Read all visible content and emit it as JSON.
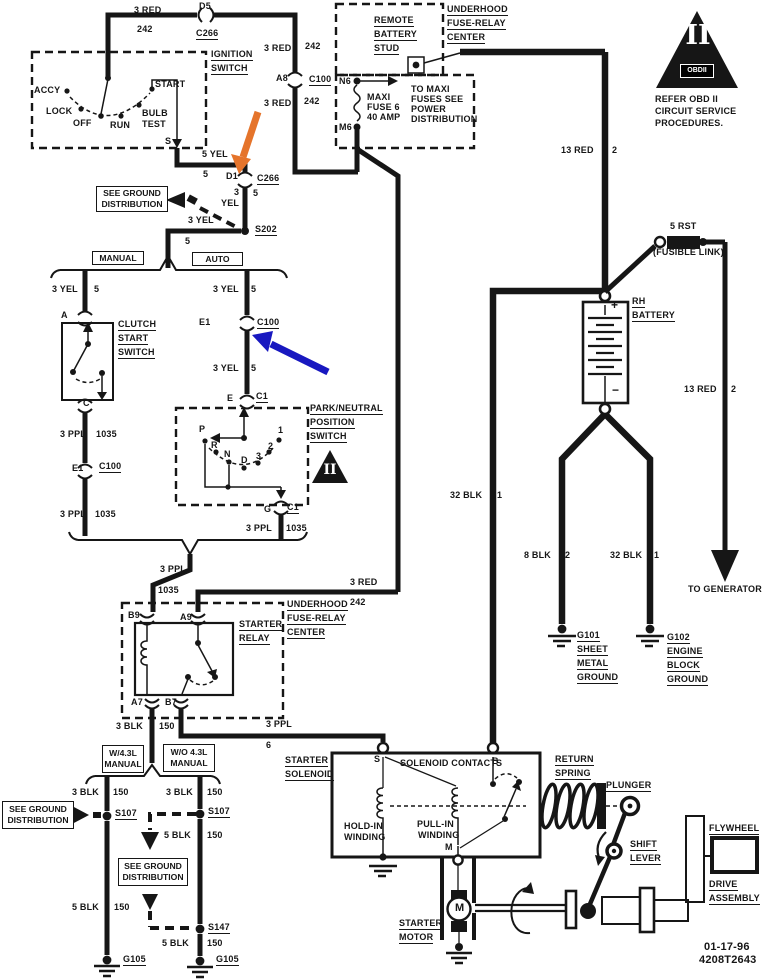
{
  "colors": {
    "paper": "#ffffff",
    "ink": "#161616",
    "arrow_orange": "#e5742b",
    "arrow_blue": "#1818c0"
  },
  "obd_notice": {
    "numeral": "II",
    "badge": "OBDII"
  },
  "pn_triangle": {
    "numeral": "II"
  },
  "footer": {
    "date": "01-17-96",
    "code": "4208T2643"
  },
  "boxed_labels": [
    {
      "n": "see-ground-distribution-top",
      "x": 96,
      "y": 186,
      "w": 70,
      "h": 24,
      "lines": [
        "SEE GROUND",
        "DISTRIBUTION"
      ]
    },
    {
      "n": "manual-tag",
      "x": 92,
      "y": 251,
      "w": 50,
      "h": 12,
      "lines": [
        "MANUAL"
      ]
    },
    {
      "n": "auto-tag",
      "x": 192,
      "y": 252,
      "w": 49,
      "h": 12,
      "lines": [
        "AUTO"
      ]
    },
    {
      "n": "w-43l-manual-tag",
      "x": 102,
      "y": 745,
      "w": 40,
      "h": 26,
      "lines": [
        "W/4.3L",
        "MANUAL"
      ]
    },
    {
      "n": "wo-43l-manual-tag",
      "x": 163,
      "y": 744,
      "w": 50,
      "h": 26,
      "lines": [
        "W/O 4.3L",
        "MANUAL"
      ]
    },
    {
      "n": "see-ground-distribution-left",
      "x": 2,
      "y": 801,
      "w": 70,
      "h": 26,
      "lines": [
        "SEE GROUND",
        "DISTRIBUTION"
      ]
    },
    {
      "n": "see-ground-distribution-bottom",
      "x": 118,
      "y": 858,
      "w": 68,
      "h": 26,
      "lines": [
        "SEE GROUND",
        "DISTRIBUTION"
      ]
    }
  ],
  "labels": [
    {
      "n": "wire-3red-top",
      "t": "3 RED",
      "x": 134,
      "y": 5
    },
    {
      "n": "wire-242-top",
      "t": "242",
      "x": 137,
      "y": 24
    },
    {
      "n": "conn-d5",
      "t": "D5",
      "x": 199,
      "y": 1
    },
    {
      "n": "conn-c266-top",
      "t": "C266",
      "x": 196,
      "y": 28,
      "u": 1
    },
    {
      "n": "wire-3red-2",
      "t": "3 RED",
      "x": 264,
      "y": 43
    },
    {
      "n": "wire-242-2",
      "t": "242",
      "x": 305,
      "y": 41
    },
    {
      "n": "conn-a8",
      "t": "A8",
      "x": 276,
      "y": 73
    },
    {
      "n": "conn-c100-top",
      "t": "C100",
      "x": 309,
      "y": 74,
      "u": 1
    },
    {
      "n": "wire-3red-3",
      "t": "3 RED",
      "x": 264,
      "y": 98
    },
    {
      "n": "wire-242-3",
      "t": "242",
      "x": 304,
      "y": 96
    },
    {
      "n": "ignition-label-1",
      "t": "IGNITION",
      "x": 211,
      "y": 49,
      "u": 1
    },
    {
      "n": "ignition-label-2",
      "t": "SWITCH",
      "x": 211,
      "y": 63,
      "u": 1
    },
    {
      "n": "pos-accy",
      "t": "ACCY",
      "x": 34,
      "y": 85
    },
    {
      "n": "pos-lock",
      "t": "LOCK",
      "x": 46,
      "y": 106
    },
    {
      "n": "pos-off",
      "t": "OFF",
      "x": 73,
      "y": 118
    },
    {
      "n": "pos-run",
      "t": "RUN",
      "x": 110,
      "y": 120
    },
    {
      "n": "pos-bulb",
      "t": "BULB",
      "x": 142,
      "y": 108
    },
    {
      "n": "pos-test",
      "t": "TEST",
      "x": 142,
      "y": 119
    },
    {
      "n": "pos-start",
      "t": "START",
      "x": 155,
      "y": 79
    },
    {
      "n": "term-s-ign",
      "t": "S",
      "x": 165,
      "y": 136
    },
    {
      "n": "wire-5yel",
      "t": "5 YEL",
      "x": 202,
      "y": 149
    },
    {
      "n": "wire-5-a",
      "t": "5",
      "x": 203,
      "y": 169
    },
    {
      "n": "conn-d1",
      "t": "D1",
      "x": 226,
      "y": 171
    },
    {
      "n": "conn-c266-mid",
      "t": "C266",
      "x": 257,
      "y": 173,
      "u": 1
    },
    {
      "n": "wire-3-b",
      "t": "3",
      "x": 234,
      "y": 187
    },
    {
      "n": "wire-5-b",
      "t": "5",
      "x": 253,
      "y": 188
    },
    {
      "n": "wire-yel-b",
      "t": "YEL",
      "x": 221,
      "y": 198
    },
    {
      "n": "splice-s202",
      "t": "S202",
      "x": 255,
      "y": 224,
      "u": 1
    },
    {
      "n": "wire-3yel-s202",
      "t": "3 YEL",
      "x": 188,
      "y": 215
    },
    {
      "n": "wire-5-s202",
      "t": "5",
      "x": 185,
      "y": 236
    },
    {
      "n": "wire-3yel-man",
      "t": "3 YEL",
      "x": 52,
      "y": 284
    },
    {
      "n": "wire-5-man",
      "t": "5",
      "x": 94,
      "y": 284
    },
    {
      "n": "term-a-clutch",
      "t": "A",
      "x": 61,
      "y": 310
    },
    {
      "n": "clutch-label-1",
      "t": "CLUTCH",
      "x": 118,
      "y": 319,
      "u": 1
    },
    {
      "n": "clutch-label-2",
      "t": "START",
      "x": 118,
      "y": 333,
      "u": 1
    },
    {
      "n": "clutch-label-3",
      "t": "SWITCH",
      "x": 118,
      "y": 347,
      "u": 1
    },
    {
      "n": "term-c-clutch",
      "t": "C",
      "x": 83,
      "y": 398
    },
    {
      "n": "wire-3ppl-man1",
      "t": "3 PPL",
      "x": 60,
      "y": 429
    },
    {
      "n": "wire-1035-man1",
      "t": "1035",
      "x": 96,
      "y": 429
    },
    {
      "n": "conn-e1-man",
      "t": "E1",
      "x": 72,
      "y": 463
    },
    {
      "n": "conn-c100-man",
      "t": "C100",
      "x": 99,
      "y": 461,
      "u": 1
    },
    {
      "n": "wire-3ppl-man2",
      "t": "3 PPL",
      "x": 60,
      "y": 509
    },
    {
      "n": "wire-1035-man2",
      "t": "1035",
      "x": 95,
      "y": 509
    },
    {
      "n": "wire-3yel-auto1",
      "t": "3 YEL",
      "x": 213,
      "y": 284
    },
    {
      "n": "wire-5-auto1",
      "t": "5",
      "x": 251,
      "y": 284
    },
    {
      "n": "conn-e1-auto",
      "t": "E1",
      "x": 199,
      "y": 317
    },
    {
      "n": "conn-c100-auto",
      "t": "C100",
      "x": 257,
      "y": 317,
      "u": 1
    },
    {
      "n": "wire-3yel-auto2",
      "t": "3 YEL",
      "x": 213,
      "y": 363
    },
    {
      "n": "wire-5-auto2",
      "t": "5",
      "x": 251,
      "y": 363
    },
    {
      "n": "term-e-pn",
      "t": "E",
      "x": 227,
      "y": 393
    },
    {
      "n": "conn-c1-top",
      "t": "C1",
      "x": 256,
      "y": 391,
      "u": 1
    },
    {
      "n": "pn-label-1",
      "t": "PARK/NEUTRAL",
      "x": 310,
      "y": 403,
      "u": 1
    },
    {
      "n": "pn-label-2",
      "t": "POSITION",
      "x": 310,
      "y": 417,
      "u": 1
    },
    {
      "n": "pn-label-3",
      "t": "SWITCH",
      "x": 310,
      "y": 431,
      "u": 1
    },
    {
      "n": "pn-pos-p",
      "t": "P",
      "x": 199,
      "y": 424
    },
    {
      "n": "pn-pos-r",
      "t": "R",
      "x": 211,
      "y": 440
    },
    {
      "n": "pn-pos-n",
      "t": "N",
      "x": 224,
      "y": 449
    },
    {
      "n": "pn-pos-d",
      "t": "D",
      "x": 241,
      "y": 455
    },
    {
      "n": "pn-pos-3",
      "t": "3",
      "x": 256,
      "y": 451
    },
    {
      "n": "pn-pos-2",
      "t": "2",
      "x": 268,
      "y": 441
    },
    {
      "n": "pn-pos-1",
      "t": "1",
      "x": 278,
      "y": 425
    },
    {
      "n": "term-g-pn",
      "t": "G",
      "x": 264,
      "y": 504
    },
    {
      "n": "conn-c1-bot",
      "t": "C1",
      "x": 287,
      "y": 502,
      "u": 1
    },
    {
      "n": "wire-3ppl-pn",
      "t": "3 PPL",
      "x": 246,
      "y": 523
    },
    {
      "n": "wire-1035-pn",
      "t": "1035",
      "x": 286,
      "y": 523
    },
    {
      "n": "wire-3ppl-merge",
      "t": "3 PPL",
      "x": 160,
      "y": 564
    },
    {
      "n": "wire-1035-merge",
      "t": "1035",
      "x": 158,
      "y": 585
    },
    {
      "n": "wire-3red-mid",
      "t": "3 RED",
      "x": 350,
      "y": 577
    },
    {
      "n": "wire-242-mid",
      "t": "242",
      "x": 350,
      "y": 597
    },
    {
      "n": "term-b9",
      "t": "B9",
      "x": 128,
      "y": 610
    },
    {
      "n": "term-a9",
      "t": "A9",
      "x": 180,
      "y": 612
    },
    {
      "n": "relay-label-1",
      "t": "STARTER",
      "x": 239,
      "y": 619,
      "u": 1
    },
    {
      "n": "relay-label-2",
      "t": "RELAY",
      "x": 239,
      "y": 633,
      "u": 1
    },
    {
      "n": "ufrc-label-1",
      "t": "UNDERHOOD",
      "x": 287,
      "y": 599,
      "u": 1
    },
    {
      "n": "ufrc-label-2",
      "t": "FUSE-RELAY",
      "x": 287,
      "y": 613,
      "u": 1
    },
    {
      "n": "ufrc-label-3",
      "t": "CENTER",
      "x": 287,
      "y": 627,
      "u": 1
    },
    {
      "n": "term-a7",
      "t": "A7",
      "x": 131,
      "y": 697
    },
    {
      "n": "term-b7",
      "t": "B7",
      "x": 165,
      "y": 697
    },
    {
      "n": "wire-3blk-a7",
      "t": "3 BLK",
      "x": 116,
      "y": 721
    },
    {
      "n": "wire-150-a7",
      "t": "150",
      "x": 159,
      "y": 721
    },
    {
      "n": "wire-3ppl-b7",
      "t": "3 PPL",
      "x": 266,
      "y": 719
    },
    {
      "n": "wire-6-b7",
      "t": "6",
      "x": 266,
      "y": 740
    },
    {
      "n": "ufrc-top-1",
      "t": "UNDERHOOD",
      "x": 447,
      "y": 4,
      "u": 1
    },
    {
      "n": "ufrc-top-2",
      "t": "FUSE-RELAY",
      "x": 447,
      "y": 18,
      "u": 1
    },
    {
      "n": "ufrc-top-3",
      "t": "CENTER",
      "x": 447,
      "y": 32,
      "u": 1
    },
    {
      "n": "stud-label-1",
      "t": "REMOTE",
      "x": 374,
      "y": 15,
      "u": 1
    },
    {
      "n": "stud-label-2",
      "t": "BATTERY",
      "x": 374,
      "y": 29,
      "u": 1
    },
    {
      "n": "stud-label-3",
      "t": "STUD",
      "x": 374,
      "y": 43,
      "u": 1
    },
    {
      "n": "term-n6",
      "t": "N6",
      "x": 339,
      "y": 76
    },
    {
      "n": "fuse-label-1",
      "t": "MAXI",
      "x": 367,
      "y": 92
    },
    {
      "n": "fuse-label-2",
      "t": "FUSE 6",
      "x": 367,
      "y": 102
    },
    {
      "n": "fuse-label-3",
      "t": "40 AMP",
      "x": 367,
      "y": 112
    },
    {
      "n": "term-m6",
      "t": "M6",
      "x": 339,
      "y": 122
    },
    {
      "n": "note-maxi-1",
      "t": "TO MAXI",
      "x": 411,
      "y": 84
    },
    {
      "n": "note-maxi-2",
      "t": "FUSES SEE",
      "x": 411,
      "y": 94
    },
    {
      "n": "note-maxi-3",
      "t": "POWER",
      "x": 411,
      "y": 104
    },
    {
      "n": "note-maxi-4",
      "t": "DISTRIBUTION",
      "x": 411,
      "y": 114
    },
    {
      "n": "wire-13red-1",
      "t": "13 RED",
      "x": 561,
      "y": 145
    },
    {
      "n": "wire-2-1",
      "t": "2",
      "x": 612,
      "y": 145
    },
    {
      "n": "wire-5rst",
      "t": "5 RST",
      "x": 670,
      "y": 221
    },
    {
      "n": "fusible-link",
      "t": "(FUSIBLE LINK)",
      "x": 653,
      "y": 247
    },
    {
      "n": "battery-label-1",
      "t": "RH",
      "x": 632,
      "y": 296,
      "u": 1
    },
    {
      "n": "battery-label-2",
      "t": "BATTERY",
      "x": 632,
      "y": 310,
      "u": 1
    },
    {
      "n": "battery-plus",
      "t": "+",
      "x": 611,
      "y": 300,
      "fs": 12
    },
    {
      "n": "battery-minus",
      "t": "−",
      "x": 612,
      "y": 385,
      "fs": 12
    },
    {
      "n": "wire-13red-2",
      "t": "13 RED",
      "x": 684,
      "y": 384
    },
    {
      "n": "wire-2-2",
      "t": "2",
      "x": 731,
      "y": 384
    },
    {
      "n": "wire-32blk-b",
      "t": "32 BLK",
      "x": 450,
      "y": 490
    },
    {
      "n": "wire-1-b",
      "t": "1",
      "x": 497,
      "y": 490
    },
    {
      "n": "wire-8blk",
      "t": "8 BLK",
      "x": 524,
      "y": 550
    },
    {
      "n": "wire-2-g101",
      "t": "2",
      "x": 565,
      "y": 550
    },
    {
      "n": "wire-32blk-g102",
      "t": "32 BLK",
      "x": 610,
      "y": 550
    },
    {
      "n": "wire-1-g102",
      "t": "1",
      "x": 654,
      "y": 550
    },
    {
      "n": "g101-label-1",
      "t": "G101",
      "x": 577,
      "y": 630,
      "u": 1
    },
    {
      "n": "g101-label-2",
      "t": "SHEET",
      "x": 577,
      "y": 644,
      "u": 1
    },
    {
      "n": "g101-label-3",
      "t": "METAL",
      "x": 577,
      "y": 658,
      "u": 1
    },
    {
      "n": "g101-label-4",
      "t": "GROUND",
      "x": 577,
      "y": 672,
      "u": 1
    },
    {
      "n": "g102-label-1",
      "t": "G102",
      "x": 667,
      "y": 632,
      "u": 1
    },
    {
      "n": "g102-label-2",
      "t": "ENGINE",
      "x": 667,
      "y": 646,
      "u": 1
    },
    {
      "n": "g102-label-3",
      "t": "BLOCK",
      "x": 667,
      "y": 660,
      "u": 1
    },
    {
      "n": "g102-label-4",
      "t": "GROUND",
      "x": 667,
      "y": 674,
      "u": 1
    },
    {
      "n": "to-generator",
      "t": "TO GENERATOR",
      "x": 688,
      "y": 584
    },
    {
      "n": "obd-text-1",
      "t": "REFER  OBD II",
      "x": 655,
      "y": 94
    },
    {
      "n": "obd-text-2",
      "t": "CIRCUIT SERVICE",
      "x": 655,
      "y": 106
    },
    {
      "n": "obd-text-3",
      "t": "PROCEDURES.",
      "x": 655,
      "y": 118
    },
    {
      "n": "wire-3blk-l",
      "t": "3 BLK",
      "x": 72,
      "y": 787
    },
    {
      "n": "wire-150-l",
      "t": "150",
      "x": 113,
      "y": 787
    },
    {
      "n": "wire-3blk-r",
      "t": "3 BLK",
      "x": 166,
      "y": 787
    },
    {
      "n": "wire-150-r",
      "t": "150",
      "x": 207,
      "y": 787
    },
    {
      "n": "splice-s107-l",
      "t": "S107",
      "x": 115,
      "y": 808,
      "u": 1
    },
    {
      "n": "splice-s107-r",
      "t": "S107",
      "x": 208,
      "y": 806,
      "u": 1
    },
    {
      "n": "wire-5blk-r1",
      "t": "5 BLK",
      "x": 164,
      "y": 830
    },
    {
      "n": "wire-150-r1",
      "t": "150",
      "x": 207,
      "y": 830
    },
    {
      "n": "wire-5blk-l1",
      "t": "5 BLK",
      "x": 72,
      "y": 902
    },
    {
      "n": "wire-150-l1",
      "t": "150",
      "x": 114,
      "y": 902
    },
    {
      "n": "splice-s147",
      "t": "S147",
      "x": 208,
      "y": 922,
      "u": 1
    },
    {
      "n": "wire-5blk-r2",
      "t": "5 BLK",
      "x": 162,
      "y": 938
    },
    {
      "n": "wire-150-r2",
      "t": "150",
      "x": 207,
      "y": 938
    },
    {
      "n": "ground-g105-l",
      "t": "G105",
      "x": 123,
      "y": 954,
      "u": 1
    },
    {
      "n": "ground-g105-r",
      "t": "G105",
      "x": 216,
      "y": 954,
      "u": 1
    },
    {
      "n": "solenoid-label-1",
      "t": "STARTER",
      "x": 285,
      "y": 755,
      "u": 1
    },
    {
      "n": "solenoid-label-2",
      "t": "SOLENOID",
      "x": 285,
      "y": 769,
      "u": 1
    },
    {
      "n": "term-s-sol",
      "t": "S",
      "x": 374,
      "y": 754
    },
    {
      "n": "solenoid-contacts",
      "t": "SOLENOID CONTACTS",
      "x": 400,
      "y": 758
    },
    {
      "n": "term-b-sol",
      "t": "B",
      "x": 492,
      "y": 756
    },
    {
      "n": "holdin-label-1",
      "t": "HOLD-IN",
      "x": 344,
      "y": 821
    },
    {
      "n": "holdin-label-2",
      "t": "WINDING",
      "x": 344,
      "y": 832
    },
    {
      "n": "pullin-label-1",
      "t": "PULL-IN",
      "x": 417,
      "y": 819
    },
    {
      "n": "pullin-label-2",
      "t": "WINDING",
      "x": 418,
      "y": 830
    },
    {
      "n": "term-m-sol",
      "t": "M",
      "x": 445,
      "y": 842
    },
    {
      "n": "spring-label-1",
      "t": "RETURN",
      "x": 555,
      "y": 754,
      "u": 1
    },
    {
      "n": "spring-label-2",
      "t": "SPRING",
      "x": 555,
      "y": 768,
      "u": 1
    },
    {
      "n": "plunger-label",
      "t": "PLUNGER",
      "x": 606,
      "y": 780,
      "u": 1
    },
    {
      "n": "lever-label-1",
      "t": "SHIFT",
      "x": 630,
      "y": 839,
      "u": 1
    },
    {
      "n": "lever-label-2",
      "t": "LEVER",
      "x": 630,
      "y": 853,
      "u": 1
    },
    {
      "n": "flywheel-label",
      "t": "FLYWHEEL",
      "x": 709,
      "y": 823,
      "u": 1
    },
    {
      "n": "drive-label-1",
      "t": "DRIVE",
      "x": 709,
      "y": 879,
      "u": 1
    },
    {
      "n": "drive-label-2",
      "t": "ASSEMBLY",
      "x": 709,
      "y": 893,
      "u": 1
    },
    {
      "n": "motor-label-1",
      "t": "STARTER",
      "x": 399,
      "y": 918,
      "u": 1
    },
    {
      "n": "motor-label-2",
      "t": "MOTOR",
      "x": 399,
      "y": 932,
      "u": 1
    },
    {
      "n": "motor-m",
      "t": "M",
      "x": 455,
      "y": 903,
      "fs": 11
    },
    {
      "n": "footer-date",
      "t": "01-17-96",
      "x": 704,
      "y": 942,
      "fs": 11
    },
    {
      "n": "footer-code",
      "t": "4208T2643",
      "x": 699,
      "y": 955,
      "fs": 11
    }
  ]
}
